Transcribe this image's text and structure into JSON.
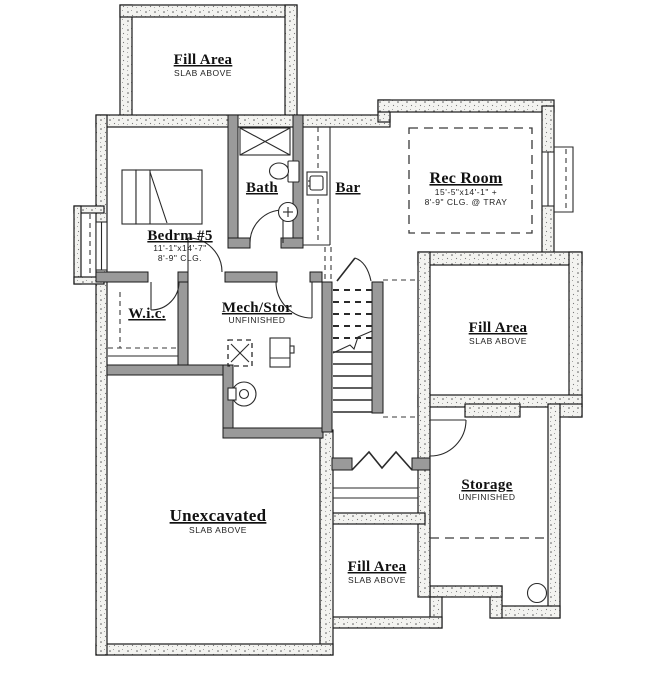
{
  "plan": {
    "type": "basement-floor-plan",
    "colors": {
      "background": "#ffffff",
      "wall_line": "#1a1a1a",
      "interior_wall": "#9a9a9a"
    },
    "rooms": [
      {
        "id": "fill-area-top",
        "title": "Fill Area",
        "sub": "SLAB ABOVE"
      },
      {
        "id": "bedroom-5",
        "title": "Bedrm #5",
        "dim": "11'-1\"x14'-7\"",
        "clg": "8'-9\" CLG."
      },
      {
        "id": "bath",
        "title": "Bath"
      },
      {
        "id": "bar",
        "title": "Bar"
      },
      {
        "id": "rec-room",
        "title": "Rec Room",
        "dim": "15'-5\"x14'-1\" +",
        "clg": "8'-9\" CLG. @ TRAY"
      },
      {
        "id": "wic",
        "title": "W.i.c."
      },
      {
        "id": "mech-stor",
        "title": "Mech/Stor",
        "sub": "UNFINISHED"
      },
      {
        "id": "fill-area-right",
        "title": "Fill Area",
        "sub": "SLAB ABOVE"
      },
      {
        "id": "unexcavated",
        "title": "Unexcavated",
        "sub": "SLAB ABOVE"
      },
      {
        "id": "storage",
        "title": "Storage",
        "sub": "UNFINISHED"
      },
      {
        "id": "fill-area-bottom",
        "title": "Fill Area",
        "sub": "SLAB ABOVE"
      }
    ],
    "fixtures": [
      "bed-icon",
      "shower-icon",
      "toilet-icon",
      "sink-icon",
      "bar-sink-icon",
      "furnace-icon",
      "water-heater-icon",
      "electrical-panel-icon",
      "sump-pump-icon",
      "staircase",
      "double-doors",
      "window-well-left",
      "window-well-right"
    ]
  }
}
